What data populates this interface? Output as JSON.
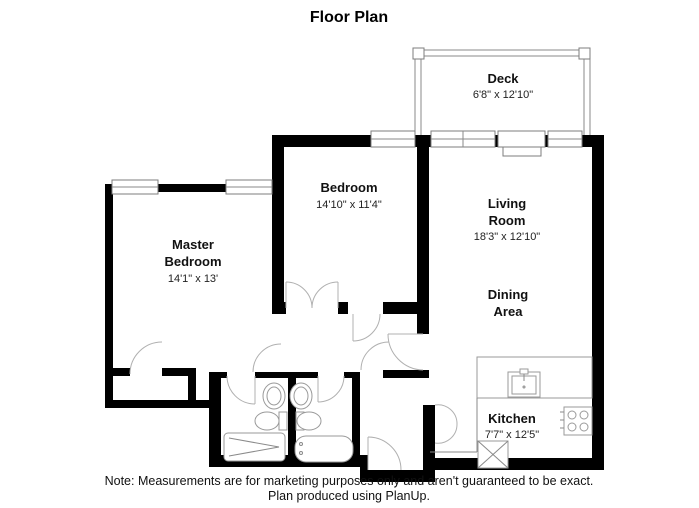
{
  "title": "Floor Plan",
  "rooms": {
    "deck": {
      "name": "Deck",
      "dims": "6'8\" x 12'10\""
    },
    "bedroom": {
      "name": "Bedroom",
      "dims": "14'10\" x 11'4\""
    },
    "living_room": {
      "name_line1": "Living",
      "name_line2": "Room",
      "dims": "18'3\" x 12'10\""
    },
    "dining_area": {
      "name_line1": "Dining",
      "name_line2": "Area"
    },
    "master_bedroom": {
      "name_line1": "Master",
      "name_line2": "Bedroom",
      "dims": "14'1\" x 13'"
    },
    "kitchen": {
      "name": "Kitchen",
      "dims": "7'7\" x 12'5\""
    }
  },
  "footer": {
    "note_line1": "Note: Measurements are for marketing purposes only and aren't guaranteed to be exact.",
    "note_line2": "Plan produced using PlanUp."
  },
  "colors": {
    "wall": "#000000",
    "background": "#ffffff",
    "thin_line": "#8a8a8a"
  }
}
